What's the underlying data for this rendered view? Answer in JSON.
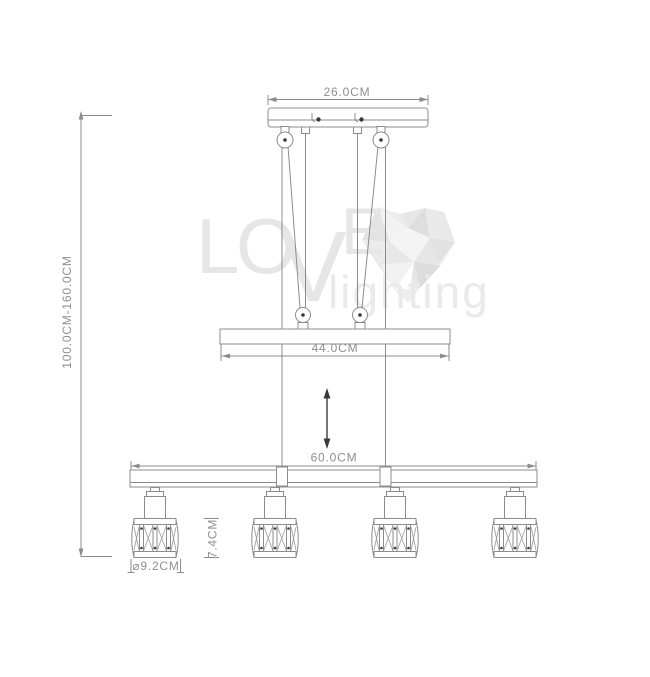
{
  "title": "pendant-lamp-dimension-drawing",
  "dimensions": {
    "canopy_width": "26.0CM",
    "overall_height": "100.0CM-160.0CM",
    "crossbar_width": "44.0CM",
    "bottom_bar_width": "60.0CM",
    "shade_height": "7.4CM",
    "shade_diameter": "⌀9.2CM"
  },
  "watermark": {
    "letters": [
      "L",
      "O",
      "V",
      "E"
    ],
    "subtitle": "lighting"
  },
  "colors": {
    "line": "#8c8c8c",
    "dim_text": "#8f8f8f",
    "screw_dot": "#3a3a3a",
    "adjust_arrow": "#3a3a3a",
    "watermark_text": "#e6e6e6",
    "background": "#ffffff"
  },
  "lamp_count": 4
}
